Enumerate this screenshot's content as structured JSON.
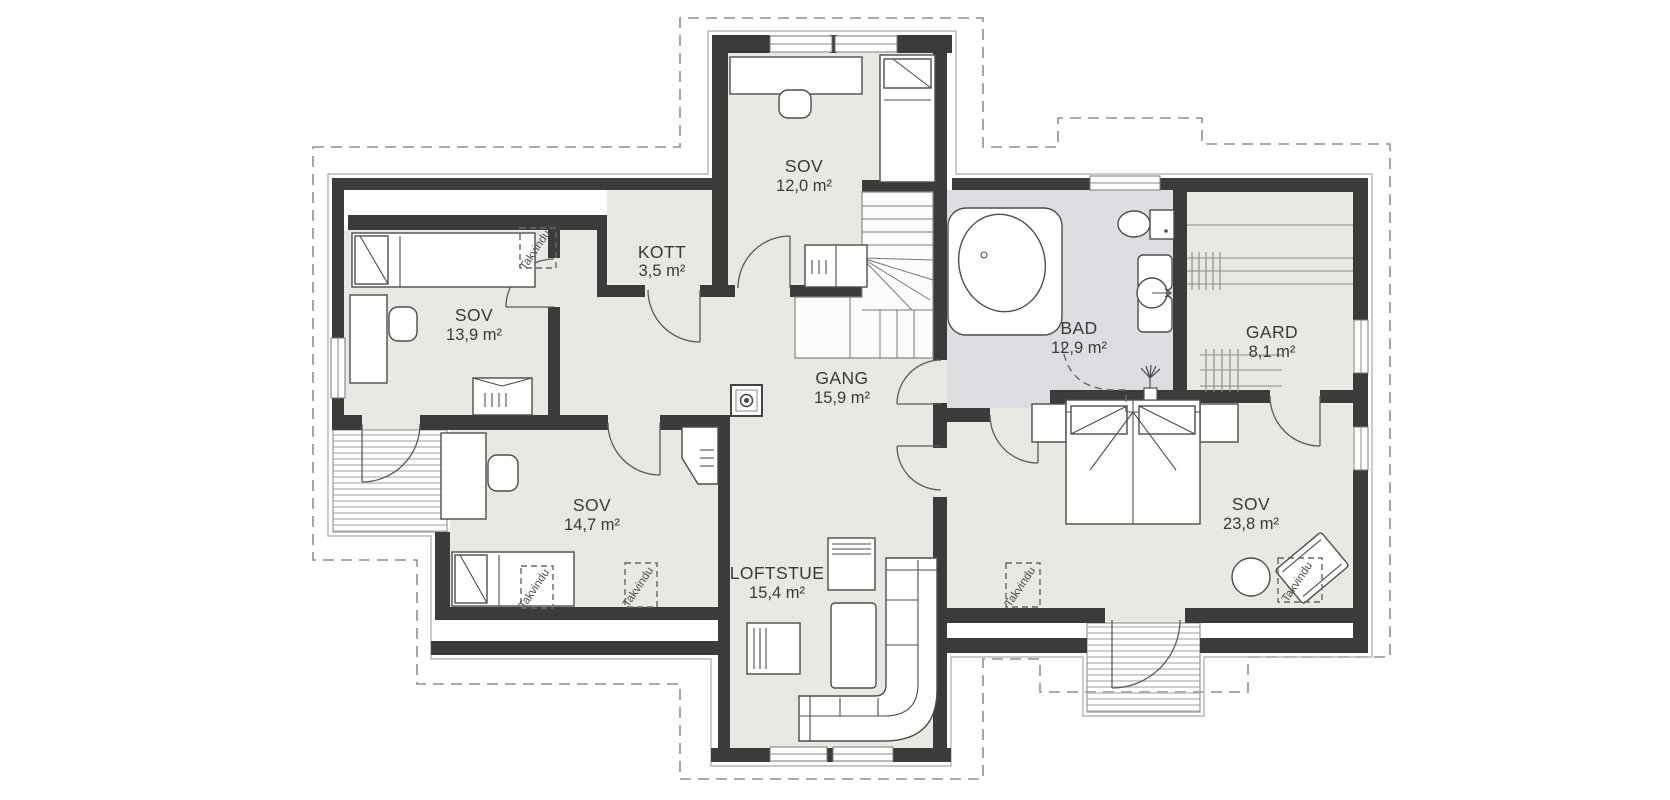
{
  "title": "Loftsplan",
  "colors": {
    "wall": "#3b3b3b",
    "floor": "#e9e8e2",
    "floor_bad": "#dcdee1",
    "roof_dash": "#8f8f8f",
    "outline_thin": "#a9a9a6",
    "balcony_hatch": "#b9b9b3"
  },
  "rooms": [
    {
      "id": "sov-top",
      "name": "SOV",
      "area": "12,0 m²"
    },
    {
      "id": "kott",
      "name": "KOTT",
      "area": "3,5 m²"
    },
    {
      "id": "sov-west",
      "name": "SOV",
      "area": "13,9 m²"
    },
    {
      "id": "bad",
      "name": "BAD",
      "area": "12,9 m²"
    },
    {
      "id": "gard",
      "name": "GARD",
      "area": "8,1 m²"
    },
    {
      "id": "gang",
      "name": "GANG",
      "area": "15,9 m²"
    },
    {
      "id": "sov-south",
      "name": "SOV",
      "area": "14,7 m²"
    },
    {
      "id": "sov-east",
      "name": "SOV",
      "area": "23,8 m²"
    },
    {
      "id": "loftstue",
      "name": "LOFTSTUE",
      "area": "15,4 m²"
    }
  ],
  "annotations": {
    "roof_window_label": "Takvindu"
  }
}
